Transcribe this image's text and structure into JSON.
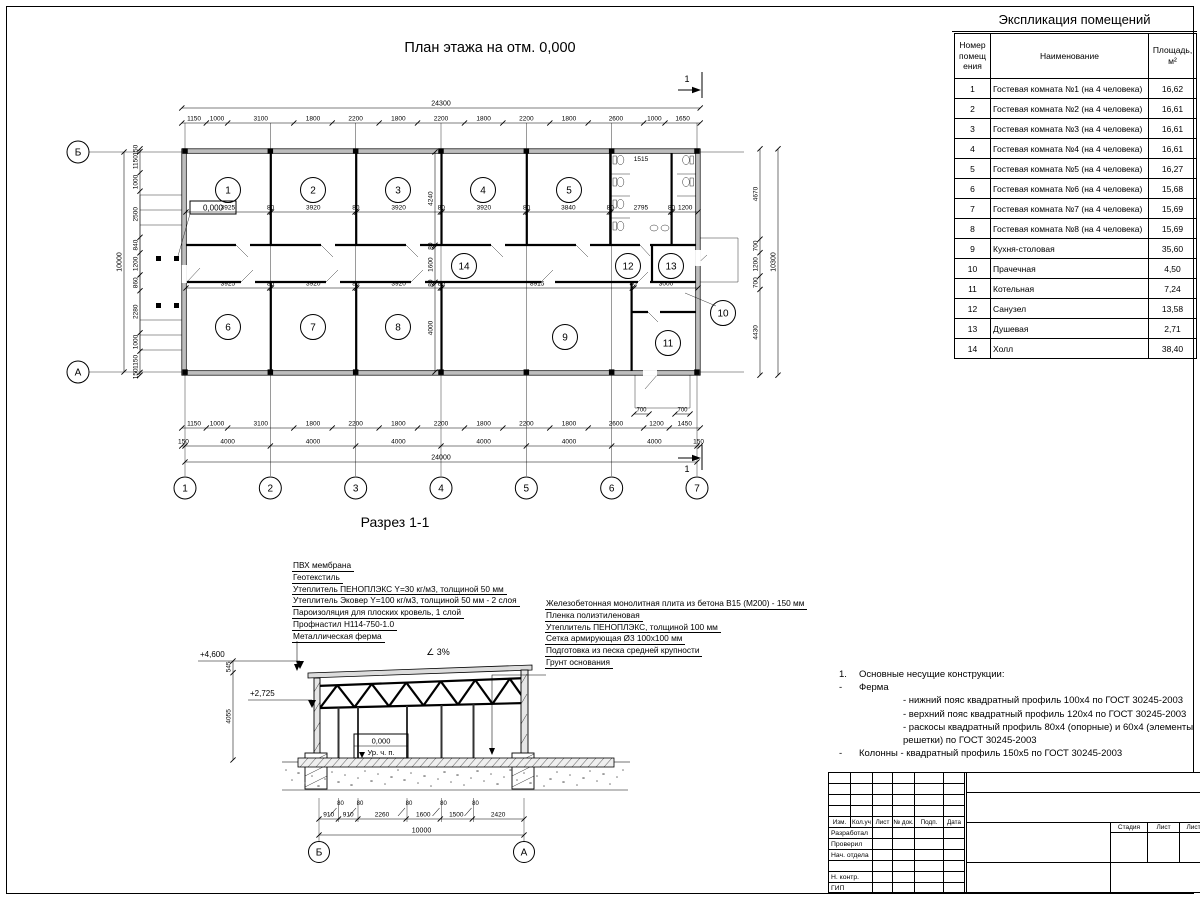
{
  "plan": {
    "title": "План этажа на отм. 0,000",
    "section_mark": "1",
    "axes_bottom": [
      "1",
      "2",
      "3",
      "4",
      "5",
      "6",
      "7"
    ],
    "axes_left": [
      "Б",
      "А"
    ],
    "dim_total_top": "24300",
    "top_chain": [
      "1150",
      "1000",
      "3100",
      "1800",
      "2200",
      "1800",
      "2200",
      "1800",
      "2200",
      "1800",
      "2600",
      "1000",
      "1650"
    ],
    "bottom_chain": [
      "1150",
      "1000",
      "3100",
      "1800",
      "2200",
      "1800",
      "2200",
      "1800",
      "2200",
      "1800",
      "2600",
      "1200",
      "1450"
    ],
    "bottom_axes_chain": [
      "150",
      "4000",
      "4000",
      "4000",
      "4000",
      "4000",
      "4000",
      "150"
    ],
    "dim_total_bottom": "24000",
    "left_chain": [
      "150",
      "1150",
      "1000",
      "2500",
      "840",
      "1200",
      "860",
      "2280",
      "1000",
      "1150",
      "150"
    ],
    "dim_total_left": "10000",
    "right_chain": [
      "4670",
      "700",
      "1200",
      "700",
      "4430"
    ],
    "dim_total_right": "10300",
    "upper_room_dims": [
      "3925",
      "80",
      "3920",
      "80",
      "3920",
      "80",
      "3920",
      "80",
      "3840",
      "80",
      "2795",
      "80",
      "1200"
    ],
    "lower_room_dims": [
      "3925",
      "80",
      "3920",
      "80",
      "3920",
      "80",
      "8915",
      "80",
      "3000"
    ],
    "vertical_room_dims": [
      "4240",
      "80",
      "1600",
      "80",
      "4000"
    ],
    "wc_dim": "1515",
    "porch_dims": [
      "700",
      "700"
    ],
    "elevation_zero": "0,000",
    "rooms": [
      "1",
      "2",
      "3",
      "4",
      "5",
      "6",
      "7",
      "8",
      "9",
      "10",
      "11",
      "12",
      "13",
      "14"
    ]
  },
  "explication": {
    "title": "Экспликация помещений",
    "col_number": "Номер помещ ения",
    "col_name": "Наименование",
    "col_area": "Площадь, м²",
    "rows": [
      {
        "n": "1",
        "name": "Гостевая комната №1 (на 4 человека)",
        "area": "16,62"
      },
      {
        "n": "2",
        "name": "Гостевая комната №2 (на 4 человека)",
        "area": "16,61"
      },
      {
        "n": "3",
        "name": "Гостевая комната №3 (на 4 человека)",
        "area": "16,61"
      },
      {
        "n": "4",
        "name": "Гостевая комната №4 (на 4 человека)",
        "area": "16,61"
      },
      {
        "n": "5",
        "name": "Гостевая комната №5 (на 4 человека)",
        "area": "16,27"
      },
      {
        "n": "6",
        "name": "Гостевая комната №6 (на 4 человека)",
        "area": "15,68"
      },
      {
        "n": "7",
        "name": "Гостевая комната №7 (на 4 человека)",
        "area": "15,69"
      },
      {
        "n": "8",
        "name": "Гостевая комната №8 (на 4 человека)",
        "area": "15,69"
      },
      {
        "n": "9",
        "name": "Кухня-столовая",
        "area": "35,60"
      },
      {
        "n": "10",
        "name": "Прачечная",
        "area": "4,50"
      },
      {
        "n": "11",
        "name": "Котельная",
        "area": "7,24"
      },
      {
        "n": "12",
        "name": "Санузел",
        "area": "13,58"
      },
      {
        "n": "13",
        "name": "Душевая",
        "area": "2,71"
      },
      {
        "n": "14",
        "name": "Холл",
        "area": "38,40"
      }
    ]
  },
  "section": {
    "title": "Разрез 1-1",
    "roof_layers": [
      "ПВХ мембрана",
      "Геотекстиль",
      "Утеплитель ПЕНОПЛЭКС Y=30 кг/м3, толщиной 50 мм",
      "Утеплитель Эковер Y=100 кг/м3, толщиной 50 мм - 2 слоя",
      "Пароизоляция для плоских кровель, 1 слой",
      "Профнастил Н114-750-1.0",
      "Металлическая ферма"
    ],
    "floor_layers": [
      "Железобетонная монолитная плита из бетона В15 (М200) - 150 мм",
      "Пленка полиэтиленовая",
      "Утеплитель ПЕНОПЛЭКС, толщиной 100 мм",
      "Сетка армирующая Ø3 100х100 мм",
      "Подготовка из песка средней крупности",
      "Грунт основания"
    ],
    "elev_top": "+4,600",
    "elev_truss": "+2,725",
    "elev_zero": "0,000",
    "floor_level_label": "Ур. ч. п.",
    "slope": "3%",
    "left_dims": [
      "545",
      "4055"
    ],
    "bottom_dims": [
      "910",
      "910",
      "2260",
      "1600",
      "1500",
      "2420"
    ],
    "col_dims": [
      "80",
      "80",
      "80",
      "80",
      "80"
    ],
    "dim_total": "10000",
    "axes": [
      "Б",
      "А"
    ]
  },
  "notes": {
    "items": [
      {
        "marker": "1.",
        "text": "Основные несущие конструкции:",
        "indent": 0
      },
      {
        "marker": "-",
        "text": "Ферма",
        "indent": 0
      },
      {
        "marker": "",
        "text": "- нижний пояс квадратный профиль 100х4 по ГОСТ 30245-2003",
        "indent": 1
      },
      {
        "marker": "",
        "text": "- верхний пояс квадратный профиль 120х4 по ГОСТ 30245-2003",
        "indent": 1
      },
      {
        "marker": "",
        "text": "- раскосы квадратный профиль 80х4 (опорные) и 60х4 (элементы решетки) по ГОСТ 30245-2003",
        "indent": 1
      },
      {
        "marker": "-",
        "text": "Колонны - квадратный профиль 150х5 по ГОСТ 30245-2003",
        "indent": 0
      }
    ]
  },
  "titleblock": {
    "cols": [
      "Изм.",
      "Кол.уч",
      "Лист",
      "№ док.",
      "Подп.",
      "Дата"
    ],
    "rows": [
      "Разработал",
      "Проверил",
      "Нач. отдела",
      "",
      "Н. контр.",
      "ГИП"
    ],
    "stadia": "Стадия",
    "list": "Лист",
    "listov": "Листов"
  }
}
